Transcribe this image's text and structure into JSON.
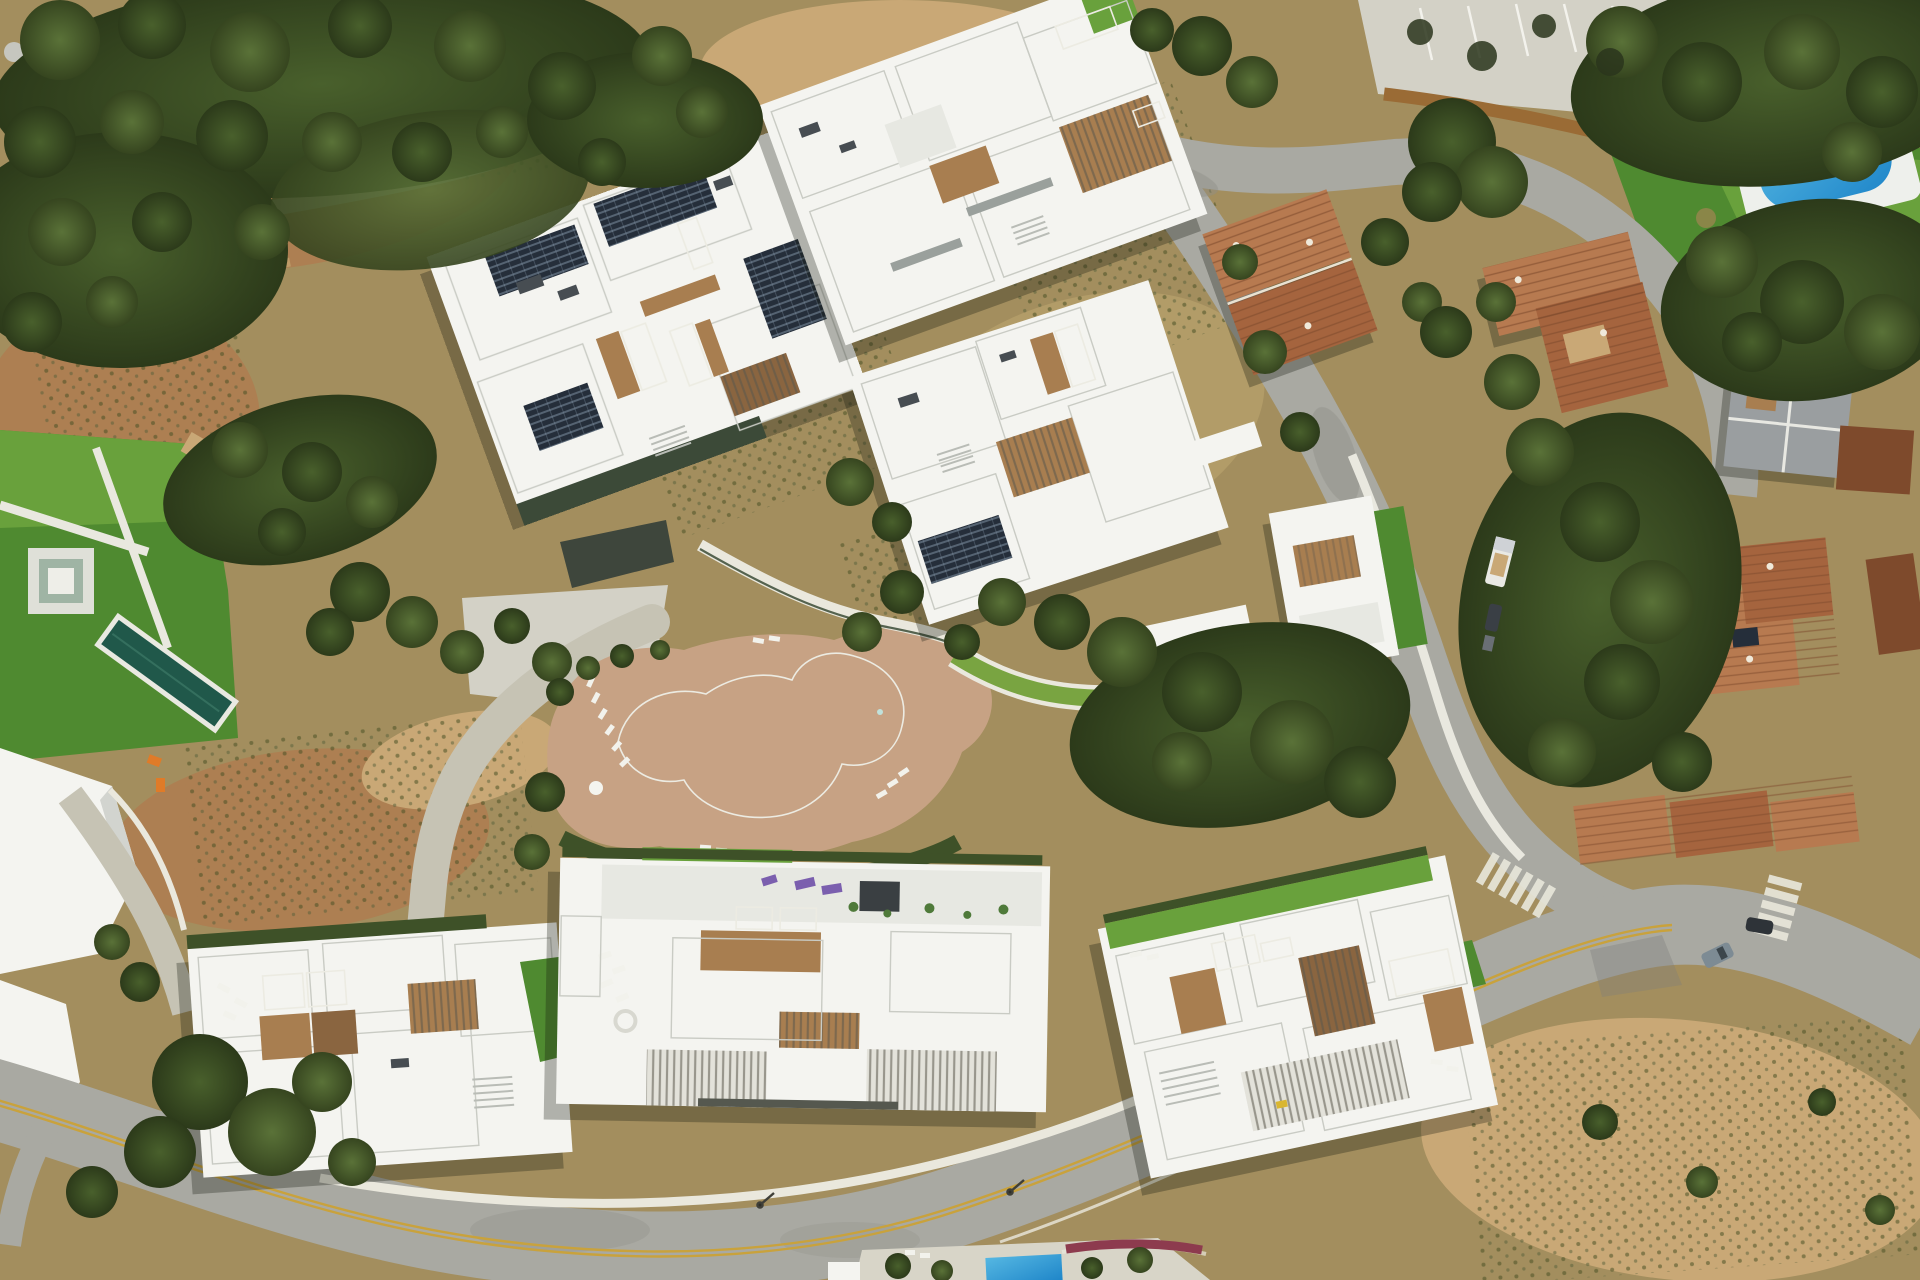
{
  "meta": {
    "description": "Aerial drone photograph, looking straight down, of a modern hillside residential development: six large white flat-roofed apartment blocks with private rooftop plunge pools, blue pool covers, solar panels and timber deck terraces; a free-form turquoise communal lagoon pool on a tan timber deck with white sun loungers; curving grey access roads (one with a double yellow centre line, zebra crossings at a Y-junction); neighbouring terracotta-roofed villas, a grey-roofed villa, a bright blue rectangular pool on a lawn at the top right, a private lap pool on a lawn at the left, dry scrub slopes, dirt tracks and dense dark-green Mediterranean woodland.",
    "view": "top-down aerial / drone orthophoto",
    "image_width": 1920,
    "image_height": 1280
  },
  "palette": {
    "terrain_base": "#a38e5e",
    "dry_grass": "#b29c68",
    "dirt": "#ad7f52",
    "dirt_light": "#c9a876",
    "rubble_gray": "#c6c6bf",
    "scrub_green": "#5d6b38",
    "tree_green_dark": "#36451f",
    "tree_green": "#4e6331",
    "tree_green_light": "#6a7f3d",
    "lawn_green": "#69a13c",
    "lawn_green_dark": "#4f8a30",
    "hedge_green": "#3e5128",
    "road_asphalt": "#a9a9a2",
    "road_worn": "#8f8f88",
    "concrete_light": "#d3d1c6",
    "drive_concrete": "#c6c3b4",
    "sidewalk_white": "#e9e8df",
    "wall_brown": "#9a6b35",
    "building_white": "#f4f4f0",
    "building_offwhite": "#e7e8e2",
    "building_shadow": "#d2d4cf",
    "garage_dark": "#3e463c",
    "wood_deck": "#a87e50",
    "wood_dark": "#8a6540",
    "deck_tan": "#c7a284",
    "pool_lagoon_dark": "#2a7f72",
    "pool_lagoon_light": "#1f8e93",
    "pool_private_teal": "#20584a",
    "pool_cover_blue": "#2e6fd6",
    "pool_blue_bright": "#2f9ed3",
    "terracotta": "#a5643e",
    "terracotta_light": "#b77a50",
    "terracotta_dark": "#7e4a2c",
    "roof_gray": "#9a9ea0",
    "solar_panel": "#252e3a",
    "line_yellow": "#c9a23c",
    "line_white": "#eae8dd",
    "shadow": "rgba(20,24,12,0.30)",
    "equipment_orange": "#e07b28",
    "lounger_purple": "#7b5fae",
    "flower_red": "#8d3b4e"
  },
  "scene": {
    "buildings": [
      {
        "id": "block-a",
        "position": "upper centre-left",
        "features": [
          "solar panel arrays",
          "blue pool cover",
          "teal plunge pools",
          "timber decks",
          "dark garden wall"
        ]
      },
      {
        "id": "block-b",
        "position": "top centre",
        "features": [
          "timber pergola decks",
          "teal plunge pool",
          "blue pool cover",
          "roof lawn strip"
        ]
      },
      {
        "id": "block-c",
        "position": "middle right",
        "features": [
          "solar panels",
          "teal plunge pool",
          "timber deck",
          "white access walkway"
        ]
      },
      {
        "id": "block-d",
        "position": "bottom left",
        "features": [
          "two teal plunge pools",
          "timber decks",
          "white loungers",
          "roof stairs"
        ]
      },
      {
        "id": "block-e",
        "position": "bottom centre",
        "features": [
          "purple loungers",
          "two blue pool covers",
          "louvred pergolas",
          "spiral stair"
        ]
      },
      {
        "id": "block-f",
        "position": "bottom right",
        "features": [
          "roof lawn band",
          "teal plunge pools",
          "blue pool cover",
          "louvred pergola",
          "timber decks"
        ]
      }
    ],
    "amenities": {
      "communal_pool": "free-form turquoise lagoon pool, two lobes",
      "pool_deck": "tan timber deck with white sun loungers and umbrella",
      "green_walkway": "curved landscaped green walkway east of the lagoon",
      "lap_pool_west": "dark teal lap pool on lawn with sunken lounge",
      "blue_pool_northeast": "bright blue rectangular pool with white surround on lawn"
    },
    "neighborhood": [
      "terracotta-roof apartment block (upper right)",
      "terracotta-roof block beside loop road",
      "grey-roof villa (far right)",
      "terracotta villa cluster with solar panels (right)",
      "terracotta villa row along lower road",
      "white villa with lawn east of access road"
    ],
    "roads": [
      "main access road winding north-south on the right",
      "wide lower boulevard with double yellow centre line",
      "north-east loop road past parking bays",
      "zebra crossings at the Y-junction",
      "light concrete internal driveway"
    ],
    "vehicles": [
      "white truck on access road",
      "dark car with trailer",
      "grey car at junction",
      "dark SUV at junction",
      "white car by north-east pool"
    ],
    "vegetation": [
      "dense oak woodland top left",
      "dirt tracks through scrub",
      "planted scrub rows on slope",
      "large tree island at loop road",
      "big tree bottom left",
      "dry slope bottom right"
    ],
    "construction": [
      "grey rubble piles top-left corner",
      "orange equipment beside west driveway"
    ]
  }
}
